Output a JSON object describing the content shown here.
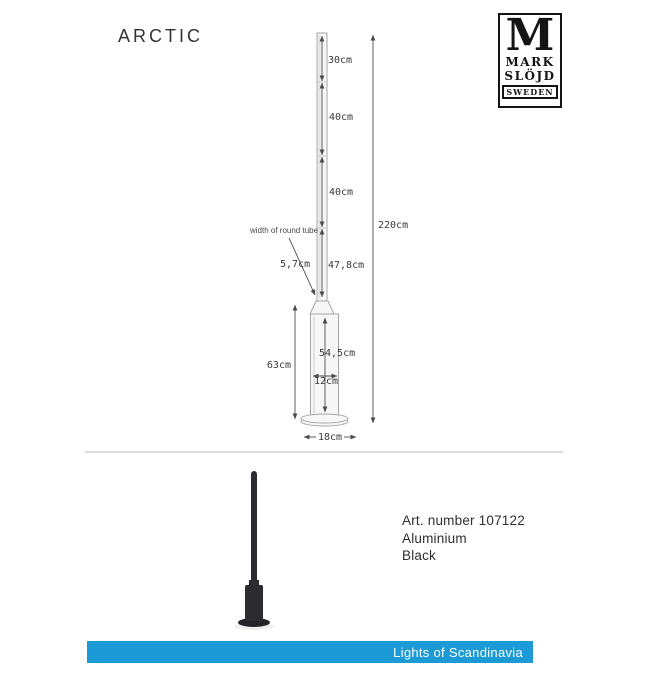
{
  "title": "ARCTIC",
  "brand": {
    "monogram": "M",
    "name_line1": "MARK",
    "name_line2": "SLÖJD",
    "country": "SWEDEN"
  },
  "diagram": {
    "segment_labels": [
      "30cm",
      "40cm",
      "40cm",
      "47,8cm"
    ],
    "total_height_label": "220cm",
    "tube_note": "width of round tube",
    "tube_width_label": "5,7cm",
    "base_section_height_label": "63cm",
    "base_tube_length_label": "54,5cm",
    "base_tube_width_label": "12cm",
    "foot_plate_width_label": "18cm"
  },
  "product_info": {
    "art_number": "Art. number 107122",
    "material": "Aluminium",
    "finish": "Black"
  },
  "footer": {
    "brand_text": "Lights of Scandinavia",
    "bar_color": "#1b9ad6"
  },
  "colors": {
    "pole_black": "#2b2b30",
    "drawing_line": "#a6a6a6",
    "dimension_text": "#3a3a3a"
  }
}
